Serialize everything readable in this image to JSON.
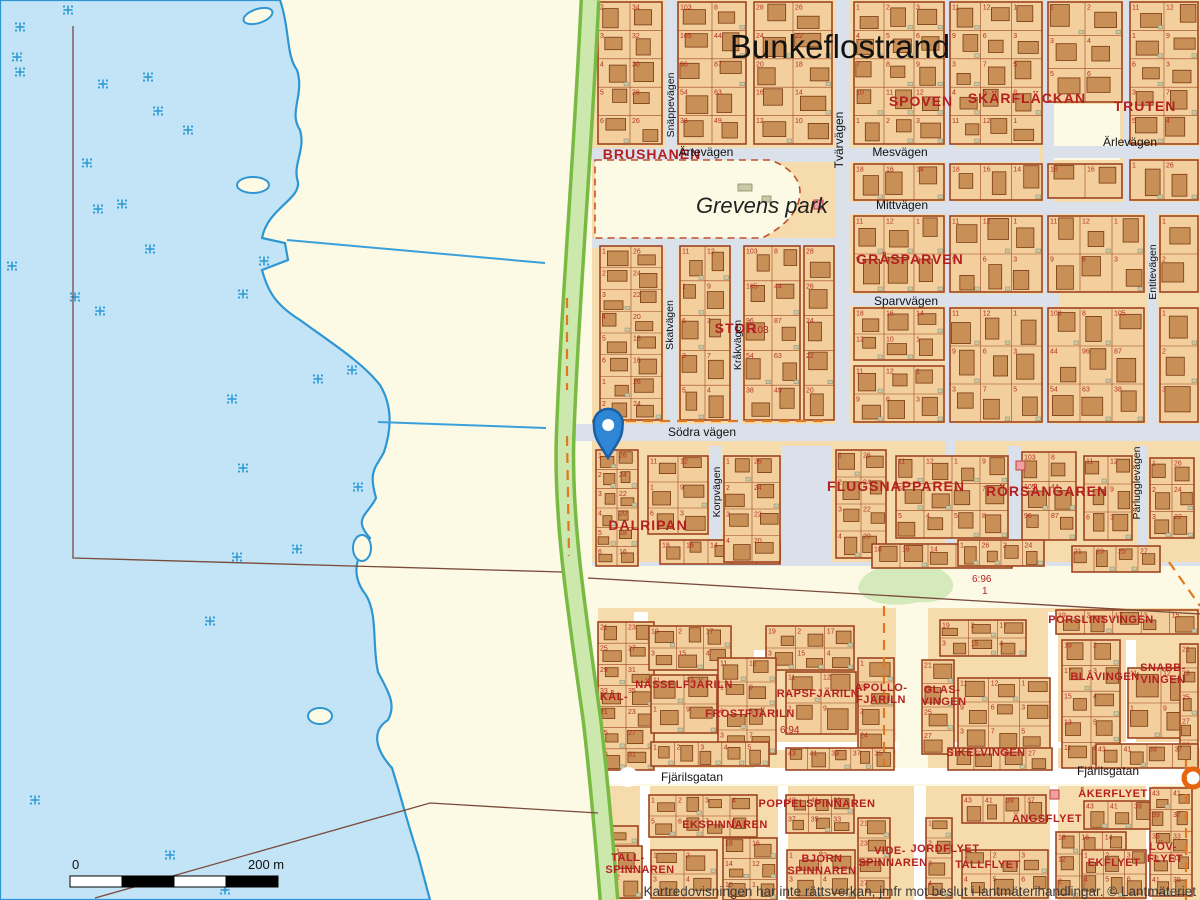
{
  "map": {
    "title": "Bunkeflostrand",
    "park_label": "Grevens park",
    "copyright": "Kartredovisningen har inte rättsverkan, jmfr mot beslut i lantmäterihandlingar. © Lantmäteriet",
    "scale_bar": {
      "start_label": "0",
      "end_label": "200 m"
    },
    "marker": {
      "name": "location-pin",
      "color": "#2e86d4",
      "outline": "#1a5fa5"
    },
    "colors": {
      "water": "#c2e4f6",
      "shore": "#2e96d2",
      "land": "#fcfae5",
      "urban": "#f6dcac",
      "block": "#f2cf9c",
      "house": "#c88f56",
      "outline": "#9e4420",
      "road_top": "#dae1eb",
      "road_lower": "#ffffff",
      "green_fill": "#cde8ac",
      "green_edge": "#79ba43",
      "red_text": "#b51f1f",
      "dashed_boundary": "#e07820",
      "solid_boundary": "#7a4a3a",
      "marsh": "#2e9bd6",
      "pink_building": "#f0a0a0"
    },
    "parcel_labels": [
      {
        "text": "6:96",
        "x": 972,
        "y": 582
      },
      {
        "text": "1",
        "x": 982,
        "y": 594
      },
      {
        "text": "6:94",
        "x": 780,
        "y": 733
      },
      {
        "text": "103",
        "x": 752,
        "y": 333
      }
    ],
    "block_labels": [
      {
        "text": "BRUSHANEN",
        "x": 652,
        "y": 159
      },
      {
        "text": "SPOVEN",
        "x": 921,
        "y": 106
      },
      {
        "text": "SKÄRFLÄCKAN",
        "x": 1027,
        "y": 103
      },
      {
        "text": "TRUTEN",
        "x": 1145,
        "y": 111
      },
      {
        "text": "GRÅSPARVEN",
        "x": 910,
        "y": 264
      },
      {
        "text": "STOR",
        "x": 736,
        "y": 333
      },
      {
        "text": "DALRIPAN",
        "x": 648,
        "y": 530
      },
      {
        "text": "FLUGSNAPPAREN",
        "x": 896,
        "y": 491
      },
      {
        "text": "RÖRSÅNGAREN",
        "x": 1047,
        "y": 496
      },
      {
        "text": "NÄSSELFJÄRILN",
        "x": 684,
        "y": 688,
        "sm": true
      },
      {
        "text": "KÅL-",
        "x": 614,
        "y": 700,
        "sm": true
      },
      {
        "text": "FROSTFJÄRILN",
        "x": 750,
        "y": 717,
        "sm": true
      },
      {
        "text": "RAPSFJÄRILN",
        "x": 818,
        "y": 697,
        "sm": true
      },
      {
        "text": "APOLLO-",
        "x": 881,
        "y": 691,
        "sm": true
      },
      {
        "text": "FJÄRILN",
        "x": 881,
        "y": 703,
        "sm": true
      },
      {
        "text": "GLAS-",
        "x": 942,
        "y": 693,
        "sm": true
      },
      {
        "text": "VINGEN",
        "x": 944,
        "y": 705,
        "sm": true
      },
      {
        "text": "SIKELVINGEN",
        "x": 986,
        "y": 756,
        "sm": true
      },
      {
        "text": "BLÅVINGEN",
        "x": 1105,
        "y": 680,
        "sm": true
      },
      {
        "text": "SNABB-",
        "x": 1163,
        "y": 671,
        "sm": true
      },
      {
        "text": "VINGEN",
        "x": 1163,
        "y": 683,
        "sm": true
      },
      {
        "text": "PORSLINSVINGEN",
        "x": 1101,
        "y": 623,
        "sm": true
      },
      {
        "text": "POPPELSPINNAREN",
        "x": 817,
        "y": 807,
        "sm": true
      },
      {
        "text": "EKSPINNAREN",
        "x": 725,
        "y": 828,
        "sm": true
      },
      {
        "text": "TALL-",
        "x": 628,
        "y": 861,
        "sm": true
      },
      {
        "text": "SPINNAREN",
        "x": 640,
        "y": 873,
        "sm": true
      },
      {
        "text": "BJÖRN",
        "x": 822,
        "y": 862,
        "sm": true
      },
      {
        "text": "SPINNAREN",
        "x": 822,
        "y": 874,
        "sm": true
      },
      {
        "text": "VIDE-",
        "x": 890,
        "y": 854,
        "sm": true
      },
      {
        "text": "SPINNAREN",
        "x": 893,
        "y": 866,
        "sm": true
      },
      {
        "text": "JORDFLYET",
        "x": 945,
        "y": 852,
        "sm": true
      },
      {
        "text": "TALLFLYET",
        "x": 988,
        "y": 868,
        "sm": true
      },
      {
        "text": "ÄNGSFLYET",
        "x": 1047,
        "y": 822,
        "sm": true
      },
      {
        "text": "ÅKERFLYET",
        "x": 1113,
        "y": 797,
        "sm": true
      },
      {
        "text": "EKFLYET",
        "x": 1114,
        "y": 866,
        "sm": true
      },
      {
        "text": "LÖV-",
        "x": 1163,
        "y": 850,
        "sm": true
      },
      {
        "text": "FLYET",
        "x": 1165,
        "y": 862,
        "sm": true
      }
    ],
    "street_labels": [
      {
        "text": "Ärtevägen",
        "x": 706,
        "y": 156
      },
      {
        "text": "Mesvägen",
        "x": 900,
        "y": 156
      },
      {
        "text": "Ärlevägen",
        "x": 1130,
        "y": 146
      },
      {
        "text": "Mittvägen",
        "x": 902,
        "y": 209
      },
      {
        "text": "Sparvvägen",
        "x": 906,
        "y": 305
      },
      {
        "text": "Södra vägen",
        "x": 702,
        "y": 436
      },
      {
        "text": "Fjärilsgatan",
        "x": 692,
        "y": 781
      },
      {
        "text": "Fjärilsgatan",
        "x": 1108,
        "y": 775
      },
      {
        "text": "Tvärvägen",
        "x": 843,
        "y": 140,
        "rot": -90
      },
      {
        "text": "Snäppevägen",
        "x": 674,
        "y": 105,
        "rot": -90,
        "sm": true
      },
      {
        "text": "Skatvägen",
        "x": 673,
        "y": 325,
        "rot": -90,
        "sm": true
      },
      {
        "text": "Kråkvägen",
        "x": 741,
        "y": 345,
        "rot": -90,
        "sm": true
      },
      {
        "text": "Korpvägen",
        "x": 720,
        "y": 492,
        "rot": -90,
        "sm": true
      },
      {
        "text": "Entitevägen",
        "x": 1156,
        "y": 272,
        "rot": -90,
        "sm": true
      },
      {
        "text": "Pärlugglevägen",
        "x": 1140,
        "y": 483,
        "rot": -90,
        "sm": true
      }
    ],
    "lot_number_patterns": {
      "p1": [
        1,
        2,
        3,
        4,
        5,
        6,
        7,
        8,
        9,
        10,
        11,
        12
      ],
      "p2": [
        2,
        34,
        3,
        32,
        4,
        30,
        5,
        28,
        6,
        26,
        7,
        24,
        8,
        22
      ],
      "p3": [
        28,
        26,
        24,
        22,
        20,
        18,
        16,
        14,
        12,
        10,
        8,
        6
      ],
      "p4": [
        18,
        16,
        14,
        12,
        10,
        1,
        2,
        3,
        4,
        5
      ],
      "p5": [
        21,
        23,
        25,
        27,
        29,
        31,
        33,
        35
      ],
      "p6": [
        11,
        12,
        1,
        9,
        6,
        3,
        3,
        7,
        5,
        4,
        5,
        8
      ],
      "p7": [
        43,
        41,
        39,
        37,
        35,
        33,
        31
      ],
      "p8": [
        19,
        2,
        17,
        3,
        15,
        4,
        13,
        5,
        11,
        1
      ],
      "p9": [
        103,
        8,
        105,
        44,
        96,
        87,
        54,
        63,
        38,
        49
      ],
      "p10": [
        1,
        26,
        2,
        24,
        3,
        22,
        4,
        20,
        5,
        18,
        6,
        16
      ]
    }
  }
}
